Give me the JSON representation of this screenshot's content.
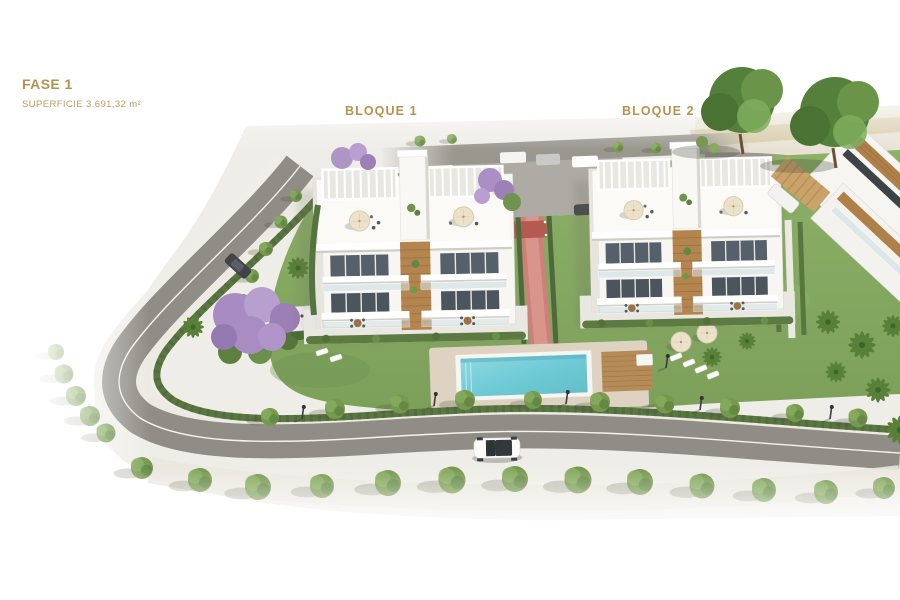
{
  "annotations": {
    "phase": {
      "label": "FASE 1",
      "area": "SUPERFICIE 3.691,32 m²"
    },
    "blocks": [
      {
        "label": "BLOQUE 1"
      },
      {
        "label": "BLOQUE 2"
      }
    ]
  },
  "colors": {
    "label_gold": "#b8914d",
    "label_gold_light": "#bf9a58",
    "pool_water": "#6fcbd6",
    "grass_green": "#86a961",
    "road_grey": "#92908a",
    "deck_beige": "#d8cbb6",
    "wood_brown": "#b5854f",
    "jacaranda_purple": "#a98cc2",
    "building_white": "#f7f6f2",
    "hedge_green": "#5a7743",
    "background": "#ffffff"
  }
}
